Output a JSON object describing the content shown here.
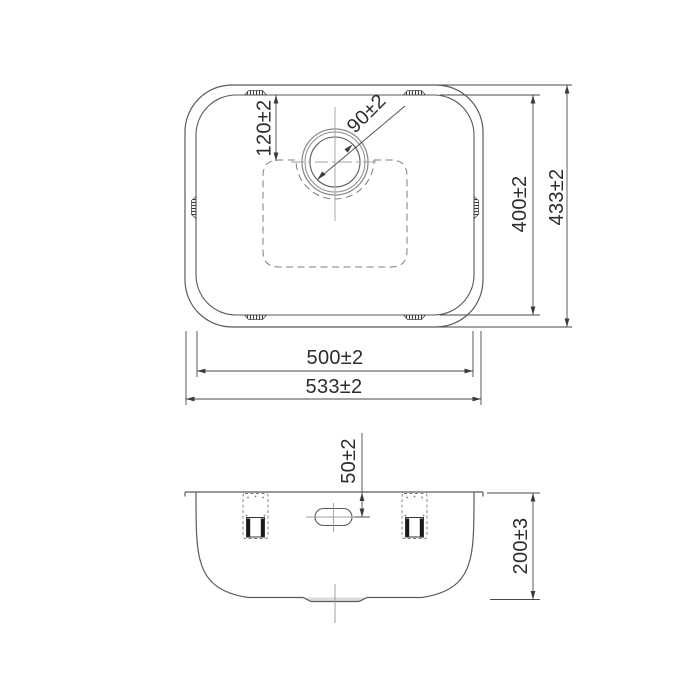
{
  "dims": {
    "drain_offset": "120±2",
    "drain_diameter": "90±2",
    "bowl_length_plan": "400±2",
    "overall_length_plan": "433±2",
    "bowl_width": "500±2",
    "overall_width": "533±2",
    "overflow_offset": "50±2",
    "bowl_depth": "200±3"
  },
  "colors": {
    "outline": "#5a5a5a",
    "dimension_line": "#4a4a4a",
    "centerline": "#9f9f9f",
    "hidden_line": "#7d7d7d",
    "text": "#2d2d2d",
    "recess_fill": "#dcdcdc",
    "background": "#ffffff"
  }
}
